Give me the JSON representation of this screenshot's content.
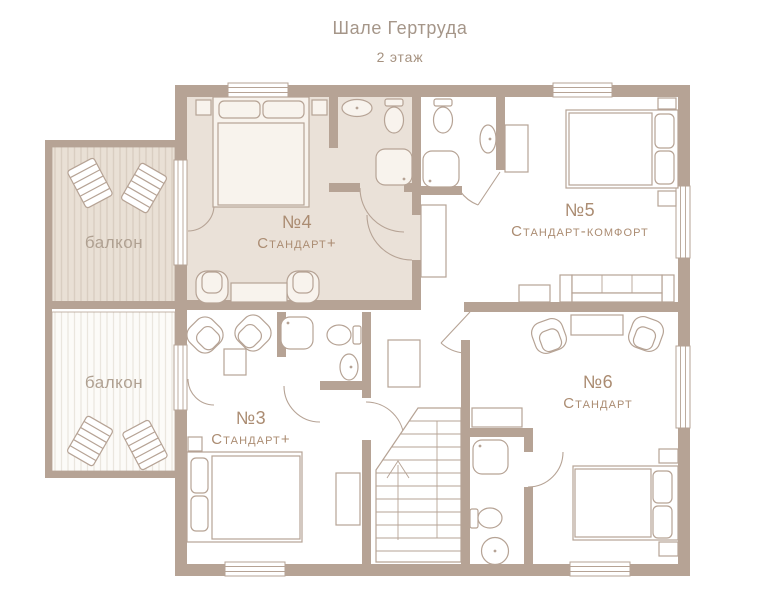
{
  "title": "Шале Гертруда",
  "subtitle": "2 этаж",
  "rooms": [
    {
      "number": "№4",
      "type": "Стандарт+"
    },
    {
      "number": "№5",
      "type": "Стандарт-комфорт"
    },
    {
      "number": "№3",
      "type": "Стандарт+"
    },
    {
      "number": "№6",
      "type": "Стандарт"
    }
  ],
  "balconies": [
    {
      "label": "балкон"
    },
    {
      "label": "балкон"
    }
  ],
  "icons": {
    "bed": "bed-icon",
    "sofa": "sofa-icon",
    "armchair": "armchair-icon",
    "lounger": "lounger-icon",
    "toilet": "toilet-icon",
    "sink": "sink-icon",
    "shower": "shower-icon",
    "stairs": "stairs-icon",
    "door": "door-arc-icon",
    "window": "window-icon",
    "wardrobe": "wardrobe-icon",
    "table": "table-icon"
  },
  "colors": {
    "wall": "#b6a395",
    "floorWhite": "#ffffff",
    "room4Fill": "#eae1d8",
    "furnBeige": "#f8f3ed",
    "balconyBeige": "#e9e0d5",
    "balconyBeigeStripe": "#d9cec1",
    "balconyWhite": "#fcfbf8",
    "balconyWhiteStripe": "#eae6de",
    "titleText": "#a59689",
    "subtitleText": "#a5917f",
    "roomText": "#ab8c72",
    "balconyText": "#b0a192"
  }
}
